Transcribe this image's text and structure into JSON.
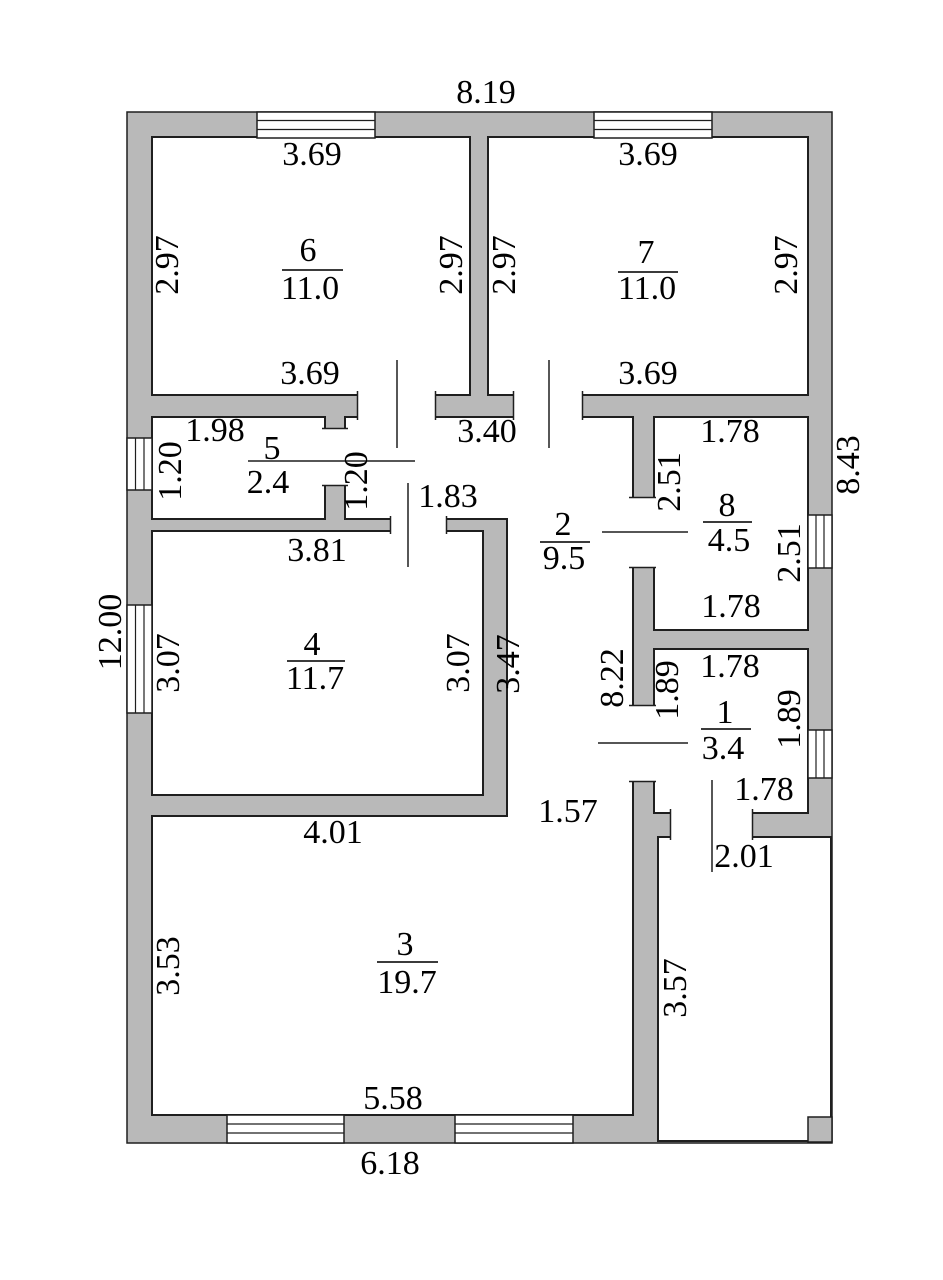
{
  "plan": {
    "type": "floor-plan",
    "units": "m",
    "colors": {
      "wall": "#b9b9b9",
      "line": "#1f1f1f",
      "background": "#ffffff",
      "text": "#000000"
    },
    "overall_dimensions": {
      "top": "8.19",
      "left": "12.00",
      "right": "8.43",
      "bottom": "6.18"
    },
    "rooms": [
      {
        "number": "1",
        "area": "3.4",
        "width": "1.78",
        "depth": "1.89"
      },
      {
        "number": "2",
        "area": "9.5",
        "width": "3.40",
        "depth": "8.22"
      },
      {
        "number": "3",
        "area": "19.7",
        "width": "5.58",
        "depth": "3.53"
      },
      {
        "number": "4",
        "area": "11.7",
        "width": "3.81",
        "depth": "3.07"
      },
      {
        "number": "5",
        "area": "2.4",
        "width": "1.98",
        "depth": "1.20"
      },
      {
        "number": "6",
        "area": "11.0",
        "width": "3.69",
        "depth": "2.97"
      },
      {
        "number": "7",
        "area": "11.0",
        "width": "3.69",
        "depth": "2.97"
      },
      {
        "number": "8",
        "area": "4.5",
        "width": "1.78",
        "depth": "2.51"
      }
    ],
    "porch": {
      "width": "2.01",
      "depth": "3.57"
    },
    "labels": [
      {
        "t": "8.19",
        "x": 486,
        "y": 93,
        "r": 0,
        "k": "dim"
      },
      {
        "t": "3.69",
        "x": 312,
        "y": 155,
        "r": 0,
        "k": "dim"
      },
      {
        "t": "3.69",
        "x": 648,
        "y": 155,
        "r": 0,
        "k": "dim"
      },
      {
        "t": "2.97",
        "x": 168,
        "y": 265,
        "r": 1,
        "k": "dim"
      },
      {
        "t": "2.97",
        "x": 452,
        "y": 265,
        "r": 1,
        "k": "dim"
      },
      {
        "t": "2.97",
        "x": 505,
        "y": 265,
        "r": 1,
        "k": "dim"
      },
      {
        "t": "2.97",
        "x": 787,
        "y": 265,
        "r": 1,
        "k": "dim"
      },
      {
        "t": "6",
        "x": 308,
        "y": 251,
        "r": 0,
        "k": "num"
      },
      {
        "t": "11.0",
        "x": 310,
        "y": 289,
        "r": 0,
        "k": "area"
      },
      {
        "t": "7",
        "x": 646,
        "y": 253,
        "r": 0,
        "k": "num"
      },
      {
        "t": "11.0",
        "x": 647,
        "y": 289,
        "r": 0,
        "k": "area"
      },
      {
        "t": "3.69",
        "x": 310,
        "y": 374,
        "r": 0,
        "k": "dim"
      },
      {
        "t": "3.69",
        "x": 648,
        "y": 374,
        "r": 0,
        "k": "dim"
      },
      {
        "t": "8.43",
        "x": 849,
        "y": 465,
        "r": 1,
        "k": "dim"
      },
      {
        "t": "12.00",
        "x": 111,
        "y": 632,
        "r": 1,
        "k": "dim"
      },
      {
        "t": "1.98",
        "x": 215,
        "y": 431,
        "r": 0,
        "k": "dim"
      },
      {
        "t": "1.20",
        "x": 171,
        "y": 471,
        "r": 1,
        "k": "dim"
      },
      {
        "t": "5",
        "x": 272,
        "y": 449,
        "r": 0,
        "k": "num"
      },
      {
        "t": "2.4",
        "x": 268,
        "y": 483,
        "r": 0,
        "k": "area"
      },
      {
        "t": "1.20",
        "x": 357,
        "y": 481,
        "r": 1,
        "k": "dim"
      },
      {
        "t": "3.40",
        "x": 487,
        "y": 432,
        "r": 0,
        "k": "dim"
      },
      {
        "t": "1.83",
        "x": 448,
        "y": 497,
        "r": 0,
        "k": "dim"
      },
      {
        "t": "1.78",
        "x": 730,
        "y": 432,
        "r": 0,
        "k": "dim"
      },
      {
        "t": "2.51",
        "x": 670,
        "y": 482,
        "r": 1,
        "k": "dim"
      },
      {
        "t": "8",
        "x": 727,
        "y": 506,
        "r": 0,
        "k": "num"
      },
      {
        "t": "4.5",
        "x": 729,
        "y": 541,
        "r": 0,
        "k": "area"
      },
      {
        "t": "2",
        "x": 563,
        "y": 525,
        "r": 0,
        "k": "num"
      },
      {
        "t": "9.5",
        "x": 564,
        "y": 559,
        "r": 0,
        "k": "area"
      },
      {
        "t": "2.51",
        "x": 790,
        "y": 553,
        "r": 1,
        "k": "dim"
      },
      {
        "t": "1.78",
        "x": 731,
        "y": 607,
        "r": 0,
        "k": "dim"
      },
      {
        "t": "3.81",
        "x": 317,
        "y": 551,
        "r": 0,
        "k": "dim"
      },
      {
        "t": "3.07",
        "x": 169,
        "y": 663,
        "r": 1,
        "k": "dim"
      },
      {
        "t": "4",
        "x": 312,
        "y": 645,
        "r": 0,
        "k": "num"
      },
      {
        "t": "11.7",
        "x": 315,
        "y": 679,
        "r": 0,
        "k": "area"
      },
      {
        "t": "3.07",
        "x": 459,
        "y": 663,
        "r": 1,
        "k": "dim"
      },
      {
        "t": "3.47",
        "x": 509,
        "y": 664,
        "r": 1,
        "k": "dim"
      },
      {
        "t": "8.22",
        "x": 613,
        "y": 678,
        "r": 1,
        "k": "dim"
      },
      {
        "t": "1.78",
        "x": 730,
        "y": 667,
        "r": 0,
        "k": "dim"
      },
      {
        "t": "1.89",
        "x": 668,
        "y": 690,
        "r": 1,
        "k": "dim"
      },
      {
        "t": "1",
        "x": 725,
        "y": 713,
        "r": 0,
        "k": "num"
      },
      {
        "t": "3.4",
        "x": 723,
        "y": 749,
        "r": 0,
        "k": "area"
      },
      {
        "t": "1.89",
        "x": 790,
        "y": 719,
        "r": 1,
        "k": "dim"
      },
      {
        "t": "1.78",
        "x": 764,
        "y": 790,
        "r": 0,
        "k": "dim"
      },
      {
        "t": "4.01",
        "x": 333,
        "y": 833,
        "r": 0,
        "k": "dim"
      },
      {
        "t": "1.57",
        "x": 568,
        "y": 812,
        "r": 0,
        "k": "dim"
      },
      {
        "t": "2.01",
        "x": 744,
        "y": 857,
        "r": 0,
        "k": "dim"
      },
      {
        "t": "3",
        "x": 405,
        "y": 945,
        "r": 0,
        "k": "num"
      },
      {
        "t": "19.7",
        "x": 407,
        "y": 983,
        "r": 0,
        "k": "area"
      },
      {
        "t": "3.53",
        "x": 169,
        "y": 966,
        "r": 1,
        "k": "dim"
      },
      {
        "t": "3.57",
        "x": 676,
        "y": 988,
        "r": 1,
        "k": "dim"
      },
      {
        "t": "5.58",
        "x": 393,
        "y": 1099,
        "r": 0,
        "k": "dim"
      },
      {
        "t": "6.18",
        "x": 390,
        "y": 1164,
        "r": 0,
        "k": "dim"
      }
    ]
  }
}
